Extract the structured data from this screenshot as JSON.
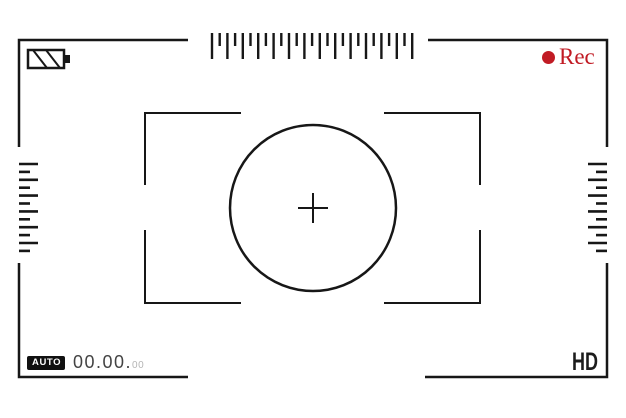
{
  "viewfinder": {
    "top_bar": {
      "battery": {
        "icon": "battery-icon"
      },
      "rec": {
        "icon": "record-dot-icon",
        "label": "Rec",
        "color": "#c11b24"
      }
    },
    "bottom_bar": {
      "mode_badge": {
        "label": "AUTO"
      },
      "timecode": {
        "main": "00.00.",
        "frames": "00"
      },
      "quality": {
        "label": "HD"
      }
    },
    "center": {
      "icon": "crosshair-icon"
    },
    "colors": {
      "line": "#171717",
      "rec_red": "#c11b24",
      "timecode_dim": "#b5b5b5"
    }
  }
}
